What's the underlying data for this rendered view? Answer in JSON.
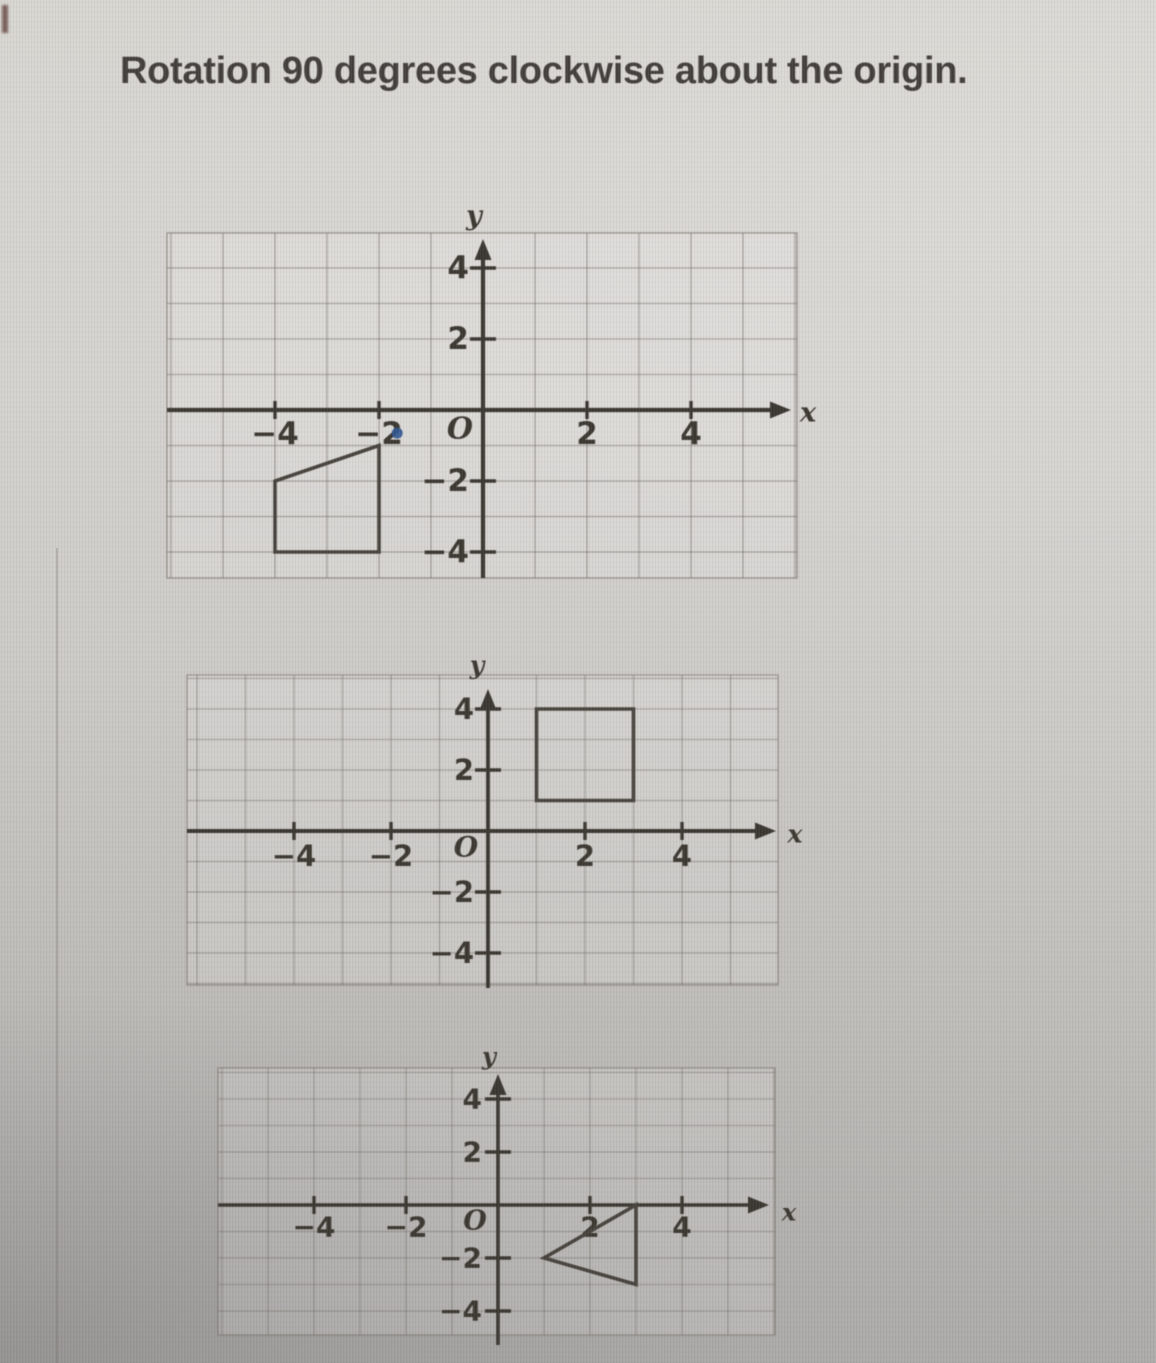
{
  "title": "Rotation 90 degrees clockwise about the origin.",
  "colors": {
    "background_top": "#d8d6d1",
    "background_bottom": "#a9a7a4",
    "axis": "#39352f",
    "shape_stroke": "#46413b",
    "grid_line": "#5f5a52",
    "number_text": "#3a362f",
    "title_text": "#403d3a",
    "annotation_blue": "#2e5490"
  },
  "graphs": [
    {
      "name": "pre-image trapezoid graph",
      "position": "top",
      "x_axis_label": "x",
      "y_axis_label": "y",
      "origin_label": "O",
      "x_ticks": [
        {
          "value": -4,
          "label": "−4"
        },
        {
          "value": -2,
          "label": "−2"
        },
        {
          "value": 2,
          "label": "2"
        },
        {
          "value": 4,
          "label": "4"
        }
      ],
      "y_ticks": [
        {
          "value": 4,
          "label": "4"
        },
        {
          "value": 2,
          "label": "2"
        },
        {
          "value": -2,
          "label": "−2"
        },
        {
          "value": -4,
          "label": "−4"
        }
      ],
      "shape": {
        "type": "quadrilateral",
        "vertices": [
          [
            -2,
            -1
          ],
          [
            -4,
            -2
          ],
          [
            -4,
            -4
          ],
          [
            -2,
            -4
          ]
        ]
      },
      "annotation_dot": {
        "x": -1.65,
        "y": -0.65
      }
    },
    {
      "name": "answer option rectangle graph",
      "position": "middle",
      "x_axis_label": "x",
      "y_axis_label": "y",
      "origin_label": "O",
      "x_ticks": [
        {
          "value": -4,
          "label": "−4"
        },
        {
          "value": -2,
          "label": "−2"
        },
        {
          "value": 2,
          "label": "2"
        },
        {
          "value": 4,
          "label": "4"
        }
      ],
      "y_ticks": [
        {
          "value": 4,
          "label": "4"
        },
        {
          "value": 2,
          "label": "2"
        },
        {
          "value": -2,
          "label": "−2"
        },
        {
          "value": -4,
          "label": "−4"
        }
      ],
      "shape": {
        "type": "rectangle",
        "vertices": [
          [
            1,
            4
          ],
          [
            3,
            4
          ],
          [
            3,
            1
          ],
          [
            1,
            1
          ]
        ]
      }
    },
    {
      "name": "answer option triangle graph",
      "position": "bottom",
      "x_axis_label": "x",
      "y_axis_label": "y",
      "origin_label": "O",
      "x_ticks": [
        {
          "value": -4,
          "label": "−4"
        },
        {
          "value": -2,
          "label": "−2"
        },
        {
          "value": 2,
          "label": "2"
        },
        {
          "value": 4,
          "label": "4"
        }
      ],
      "y_ticks": [
        {
          "value": 4,
          "label": "4"
        },
        {
          "value": 2,
          "label": "2"
        },
        {
          "value": -2,
          "label": "−2"
        },
        {
          "value": -4,
          "label": "−4"
        }
      ],
      "shape": {
        "type": "triangle",
        "vertices": [
          [
            3,
            0
          ],
          [
            3,
            -3
          ],
          [
            1,
            -2
          ]
        ]
      }
    }
  ]
}
